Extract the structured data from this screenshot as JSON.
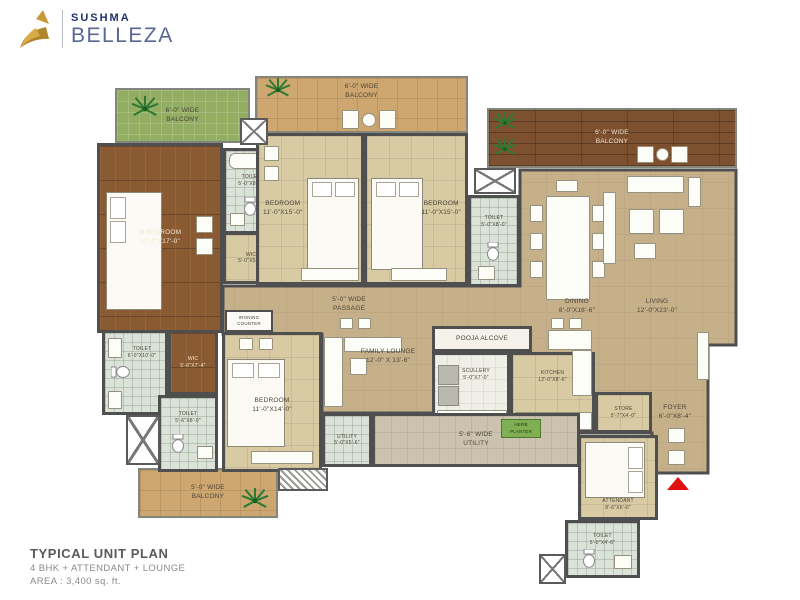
{
  "logo": {
    "brand": "SUSHMA",
    "name": "BELLEZA"
  },
  "title_block": {
    "title": "TYPICAL UNIT PLAN",
    "line2": "4 BHK + ATTENDANT + LOUNGE",
    "line3": "AREA : 3,400 sq. ft."
  },
  "colors": {
    "wall": "#4f4f4f",
    "bedroom_floor": "#d8cba4",
    "open_floor": "#c6b089",
    "wood_floor": "#8a5a33",
    "deck_wood": "#7d5030",
    "green_balcony": "#93ad62",
    "toilet_tile": "#dbe2d8",
    "balcony_tan": "#cda670",
    "utility": "#cbc3ad",
    "logo_gold": "#c79a39",
    "logo_navy": "#22306b",
    "entry_arrow": "#e01010",
    "herb_planter": "#7fae53"
  },
  "rooms": [
    {
      "l1": "M BEDROOM",
      "l2": "12'-0\"X17'-0\""
    },
    {
      "l1": "TOILET",
      "l2": "5'-0\"X8'-0\""
    },
    {
      "l1": "WIC",
      "l2": "5'-0\"X5'-0\""
    },
    {
      "l1": "BEDROOM",
      "l2": "11'-0\"X15'-0\""
    },
    {
      "l1": "BEDROOM",
      "l2": "11'-0\"X15'-0\""
    },
    {
      "l1": "TOILET",
      "l2": "5'-0\"X8'-0\""
    },
    {
      "l1": "6'-0\" WIDE",
      "l2": "BALCONY"
    },
    {
      "l1": "6'-0\" WIDE",
      "l2": "BALCONY"
    },
    {
      "l1": "6'-0\" WIDE",
      "l2": "BALCONY"
    },
    {
      "l1": "5'-0\" WIDE",
      "l2": "PASSAGE"
    },
    {
      "l1": "DINING",
      "l2": "8'-0\"X16'-6\""
    },
    {
      "l1": "LIVING",
      "l2": "12'-0\"X23'-0\""
    },
    {
      "l1": "FAMILY LOUNGE",
      "l2": "12'-0\" X 13'-6\""
    },
    {
      "l1": "POOJA ALCOVE",
      "l2": ""
    },
    {
      "l1": "SCULLERY",
      "l2": "5'-0\"X7'-0\""
    },
    {
      "l1": "KITCHEN",
      "l2": "12'-0\"X8'-6\""
    },
    {
      "l1": "TOILET",
      "l2": "6'-0\"X10'-0\""
    },
    {
      "l1": "WIC",
      "l2": "5'-6\"X7'-4\""
    },
    {
      "l1": "IRONING",
      "l2": "COUNTER"
    },
    {
      "l1": "BEDROOM",
      "l2": "11'-0\"X14'-0\""
    },
    {
      "l1": "TOILET",
      "l2": "5'-6\"X8'-0\""
    },
    {
      "l1": "UTILITY",
      "l2": "5'-0\"X5'-6\""
    },
    {
      "l1": "5'-6\" WIDE",
      "l2": "UTILITY"
    },
    {
      "l1": "HERB",
      "l2": "PLANTER"
    },
    {
      "l1": "STORE",
      "l2": "5'-7\"X4'-0\""
    },
    {
      "l1": "FOYER",
      "l2": "6'-0\"X8'-4\""
    },
    {
      "l1": "ATTENDANT",
      "l2": "8'-6\"X6'-0\""
    },
    {
      "l1": "TOILET",
      "l2": "5'-0\"X4'-6\""
    },
    {
      "l1": "5'-0\" WIDE",
      "l2": "BALCONY"
    }
  ]
}
